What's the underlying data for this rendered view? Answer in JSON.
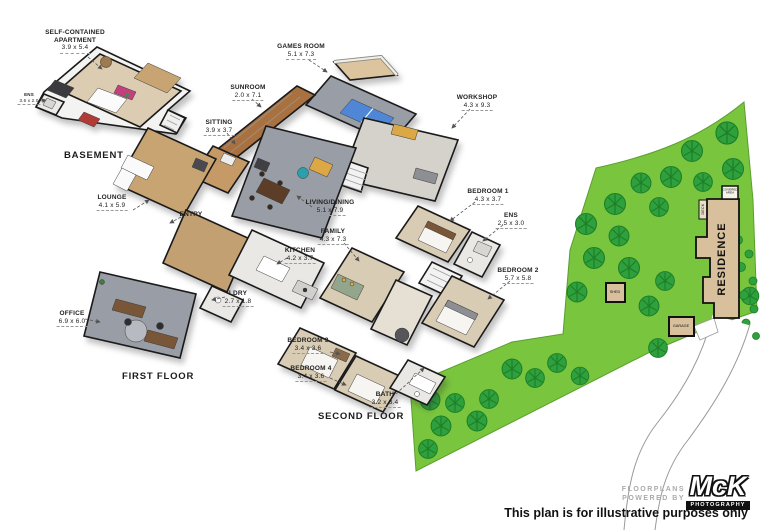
{
  "titles": {
    "basement": "BASEMENT",
    "first": "FIRST FLOOR",
    "second": "SECOND FLOOR"
  },
  "callouts": {
    "apartment": {
      "name": "SELF-CONTAINED APARTMENT",
      "dims": "3.9 x 5.4"
    },
    "basement_ens": {
      "name": "ENS",
      "dims": "3.6 x 2.0"
    },
    "games_room": {
      "name": "GAMES ROOM",
      "dims": "5.1 x 7.3"
    },
    "sunroom": {
      "name": "SUNROOM",
      "dims": "2.0 x 7.1"
    },
    "sitting": {
      "name": "SITTING",
      "dims": "3.9 x 3.7"
    },
    "workshop": {
      "name": "WORKSHOP",
      "dims": "4.3 x 9.3"
    },
    "lounge": {
      "name": "LOUNGE",
      "dims": "4.1 x 5.9"
    },
    "entry": {
      "name": "ENTRY",
      "dims": ""
    },
    "living_dining": {
      "name": "LIVING/DINING",
      "dims": "5.1 x 7.9"
    },
    "family": {
      "name": "FAMILY",
      "dims": "4.3 x 7.3"
    },
    "kitchen": {
      "name": "KITCHEN",
      "dims": "4.2 x 3.7"
    },
    "ldry": {
      "name": "LDRY",
      "dims": "2.7 x 1.8"
    },
    "office": {
      "name": "OFFICE",
      "dims": "6.9 x 6.0"
    },
    "bedroom1": {
      "name": "BEDROOM 1",
      "dims": "4.3 x 3.7"
    },
    "ens2": {
      "name": "ENS",
      "dims": "2.5 x 3.0"
    },
    "bedroom2": {
      "name": "BEDROOM 2",
      "dims": "5.7 x 5.8"
    },
    "bedroom3": {
      "name": "BEDROOM 3",
      "dims": "3.4 x 3.6"
    },
    "bedroom4": {
      "name": "BEDROOM 4",
      "dims": "3.4 x 3.6"
    },
    "bath": {
      "name": "BATH",
      "dims": "3.2 x 3.4"
    }
  },
  "site": {
    "residence": "RESIDENCE",
    "covered_area": "COVERED AREA",
    "deck": "DECK",
    "shed": "SHED",
    "garage": "GARAGE"
  },
  "footer": {
    "powered_line1": "FLOORPLANS",
    "powered_line2": "POWERED BY",
    "logo_text": "McK",
    "logo_sub": "PHOTOGRAPHY",
    "disclaimer": "This plan is for illustrative purposes only"
  },
  "colors": {
    "land_green": "#79c53e",
    "tree_green": "#2fa13c",
    "residence_tan": "#d8c09c",
    "wood_floor": "#c9a473",
    "carpet_gray": "#999da6",
    "carpet_beige": "#d9ccb4",
    "pingpong_blue": "#4f86d6"
  }
}
